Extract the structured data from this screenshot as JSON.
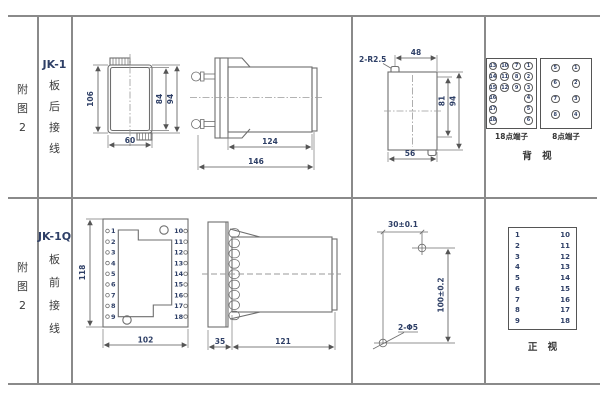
{
  "fig_label": {
    "l1": "附",
    "l2": "图",
    "l3": "2"
  },
  "row_top": {
    "model": "JK-1",
    "c1": "板",
    "c2": "后",
    "c3": "接",
    "c4": "线"
  },
  "row_bottom": {
    "model": "JK-1Q",
    "c1": "板",
    "c2": "前",
    "c3": "接",
    "c4": "线"
  },
  "jk1_front": {
    "d106": "106",
    "d84": "84",
    "d94": "94",
    "d60": "60"
  },
  "jk1_side": {
    "d124": "124",
    "d146": "146"
  },
  "cutout": {
    "r": "2-R2.5",
    "d48": "48",
    "d81": "81",
    "d94": "94",
    "d56": "56"
  },
  "jk1q_front": {
    "d118": "118",
    "d102": "102",
    "left": [
      "1",
      "2",
      "3",
      "4",
      "5",
      "6",
      "7",
      "8",
      "9"
    ],
    "right": [
      "10",
      "11",
      "12",
      "13",
      "14",
      "15",
      "16",
      "17",
      "18"
    ]
  },
  "jk1q_side": {
    "d35": "35",
    "d121": "121"
  },
  "holes": {
    "d30": "30±0.1",
    "d100": "100±0.2",
    "d5": "2-Φ5"
  },
  "terminals18": {
    "label": "18点端子",
    "full_rows": [
      [
        "13",
        "10",
        "7",
        "1"
      ],
      [
        "14",
        "11",
        "8",
        "2"
      ],
      [
        "15",
        "12",
        "9",
        "3"
      ]
    ],
    "side_rows": [
      [
        "16",
        "4"
      ],
      [
        "17",
        "5"
      ],
      [
        "18",
        "6"
      ]
    ]
  },
  "terminals8": {
    "label": "8点端子",
    "rows": [
      [
        "5",
        "1"
      ],
      [
        "6",
        "2"
      ],
      [
        "7",
        "3"
      ],
      [
        "8",
        "4"
      ]
    ]
  },
  "views": {
    "back": "背 视",
    "front": "正 视"
  },
  "front_table": {
    "left": [
      "1",
      "2",
      "3",
      "4",
      "5",
      "6",
      "7",
      "8",
      "9"
    ],
    "right": [
      "10",
      "11",
      "12",
      "13",
      "14",
      "15",
      "16",
      "17",
      "18"
    ]
  }
}
